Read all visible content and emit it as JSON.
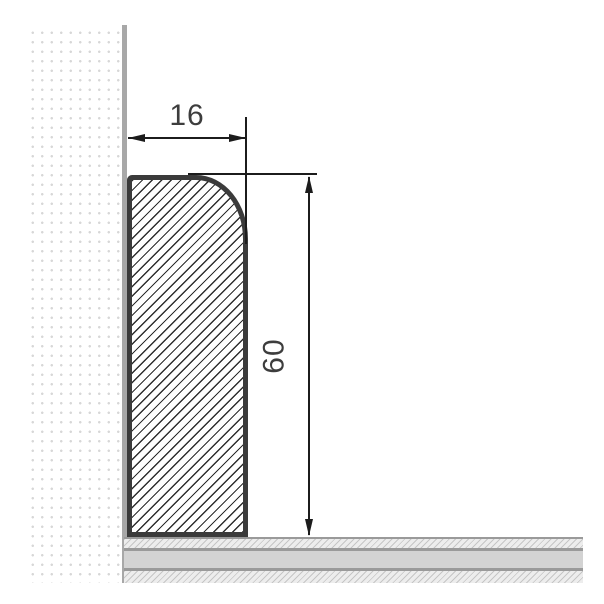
{
  "diagram": {
    "type": "skirting-board-cross-section-drawing",
    "width_dimension": {
      "label": "16"
    },
    "height_dimension": {
      "label": "60"
    }
  },
  "colors": {
    "background": "#ffffff",
    "profile_outline": "#3b3b3b",
    "profile_hatch_line": "#2e2e2e",
    "wall_surface_edge": "#a8a8a8",
    "wall_stipple_dot": "#d7d7d7",
    "floor_divider": "#9a9a9a",
    "floor_solid_layer": "#d3d3d3",
    "floor_hatch_bg": "#ededed",
    "floor_hatch_line": "#c6c6c6",
    "dimension_line": "#1c1c1c",
    "dimension_text": "#3d3d3d"
  }
}
